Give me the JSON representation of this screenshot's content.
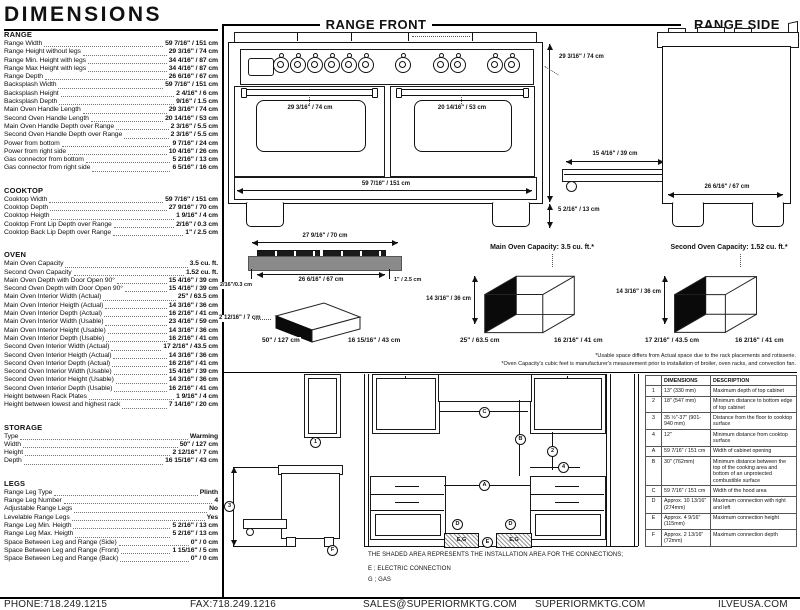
{
  "title": "DIMENSIONS",
  "specs": {
    "range": {
      "heading": "RANGE",
      "rows": [
        {
          "label": "Range Width",
          "value": "59 7/16\" / 151 cm"
        },
        {
          "label": "Range Height without legs",
          "value": "29 3/16\" / 74 cm"
        },
        {
          "label": "Range Min. Height with legs",
          "value": "34 4/16\" / 87 cm"
        },
        {
          "label": "Range Max Height with legs",
          "value": "34 4/16\" / 87 cm"
        },
        {
          "label": "Range Depth",
          "value": "26 6/16\" / 67 cm"
        },
        {
          "label": "Backsplash Width",
          "value": "59 7/16\" / 151 cm"
        },
        {
          "label": "Backsplash Height",
          "value": "2 4/16\" / 6 cm"
        },
        {
          "label": "Backsplash Depth",
          "value": "9/16\" / 1.5 cm"
        },
        {
          "label": "Main Oven Handle Length",
          "value": "29 3/16\" / 74 cm"
        },
        {
          "label": "Second Oven Handle Length",
          "value": "20 14/16\" / 53 cm"
        },
        {
          "label": "Main Oven Handle Depth over Range",
          "value": "2 3/16\" / 5.5 cm"
        },
        {
          "label": "Second Oven Handle Depth over Range",
          "value": "2 3/16\" / 5.5 cm"
        },
        {
          "label": "Power from bottom",
          "value": "9 7/16\" / 24 cm"
        },
        {
          "label": "Power from right side",
          "value": "10 4/16\" / 26 cm"
        },
        {
          "label": "Gas connector from bottom",
          "value": "5 2/16\" / 13 cm"
        },
        {
          "label": "Gas connector from right side",
          "value": "6 5/16\" / 16 cm"
        }
      ]
    },
    "cooktop": {
      "heading": "COOKTOP",
      "rows": [
        {
          "label": "Cooktop Width",
          "value": "59 7/16\" / 151 cm"
        },
        {
          "label": "Cooktop Depth",
          "value": "27 9/16\" / 70 cm"
        },
        {
          "label": "Cooktop Heigth",
          "value": "1 9/16\" / 4 cm"
        },
        {
          "label": "Cooktop Front Lip Depth over Range",
          "value": "2/16\" / 0.3 cm"
        },
        {
          "label": "Cooktop Back Lip Depth over Range",
          "value": "1\" / 2.5 cm"
        }
      ]
    },
    "oven": {
      "heading": "OVEN",
      "rows": [
        {
          "label": "Main Oven Capacity",
          "value": "3.5 cu. ft."
        },
        {
          "label": "Second Oven Capacity",
          "value": "1.52 cu. ft."
        },
        {
          "label": "Main Oven Depth with Door Open 90°",
          "value": "15 4/16\" / 39 cm"
        },
        {
          "label": "Second Oven Depth with Door Open 90°",
          "value": "15 4/16\" / 39 cm"
        },
        {
          "label": "Main Oven Interior Width (Actual)",
          "value": "25\" / 63.5 cm"
        },
        {
          "label": "Main Oven Interior Heigth (Actual)",
          "value": "14 3/16\" / 36 cm"
        },
        {
          "label": "Main Oven Interior Depth (Actual)",
          "value": "16 2/16\" / 41 cm"
        },
        {
          "label": "Main Oven Interior Width (Usable)",
          "value": "23 4/16\" / 59 cm"
        },
        {
          "label": "Main Oven Interior Height (Usable)",
          "value": "14 3/16\" / 36 cm"
        },
        {
          "label": "Main Oven Interior Depth (Usable)",
          "value": "16 2/16\" / 41 cm"
        },
        {
          "label": "Second Oven Interior Width (Actual)",
          "value": "17 2/16\" / 43.5 cm"
        },
        {
          "label": "Second Oven Interior Heigth (Actual)",
          "value": "14 3/16\" / 36 cm"
        },
        {
          "label": "Second Oven Interior Depth (Actual)",
          "value": "16 2/16\" / 41 cm"
        },
        {
          "label": "Second Oven Interior Width (Usable)",
          "value": "15 4/16\" / 39 cm"
        },
        {
          "label": "Second Oven Interior Height (Usable)",
          "value": "14 3/16\" / 36 cm"
        },
        {
          "label": "Second Oven Interior Depth (Usable)",
          "value": "16 2/16\" / 41 cm"
        },
        {
          "label": "Height between Rack Plates",
          "value": "1 9/16\" / 4 cm"
        },
        {
          "label": "Height between lowest and highest rack",
          "value": "7 14/16\" / 20 cm"
        }
      ]
    },
    "storage": {
      "heading": "STORAGE",
      "rows": [
        {
          "label": "Type",
          "value": "Warming"
        },
        {
          "label": "Width",
          "value": "50\" / 127 cm"
        },
        {
          "label": "Height",
          "value": "2 12/16\" / 7 cm"
        },
        {
          "label": "Depth",
          "value": "16 15/16\" / 43 cm"
        }
      ]
    },
    "legs": {
      "heading": "LEGS",
      "rows": [
        {
          "label": "Range Leg Type",
          "value": "Plinth"
        },
        {
          "label": "Range Leg Number",
          "value": "4"
        },
        {
          "label": "Adjustable Range Legs",
          "value": "No"
        },
        {
          "label": "Levelable Range Legs",
          "value": "Yes"
        },
        {
          "label": "Range Leg Min. Heigth",
          "value": "5 2/16\" / 13 cm"
        },
        {
          "label": "Range Leg Max. Heigth",
          "value": "5 2/16\" / 13 cm"
        },
        {
          "label": "Space Between Leg and Range (Side)",
          "value": "0\" / 0 cm"
        },
        {
          "label": "Space Between Leg and Range (Front)",
          "value": "1 15/16\" / 5 cm"
        },
        {
          "label": "Space Between Leg and Range (Back)",
          "value": "0\" / 0 cm"
        }
      ]
    }
  },
  "drawings": {
    "front": {
      "title": "RANGE FRONT",
      "main_handle": "29 3/16\" / 74 cm",
      "second_handle": "20 14/16\" / 53 cm",
      "width": "59 7/16\" / 151 cm",
      "height": "29 3/16\" / 74 cm",
      "leg_height": "5 2/16\" / 13 cm"
    },
    "side": {
      "title": "RANGE SIDE",
      "door_open": "15 4/16\" / 39 cm",
      "depth": "26 6/16\" / 67 cm"
    },
    "cooktop_profile": {
      "width": "27 9/16\" / 70 cm",
      "inner_width": "26 6/16\" / 67 cm",
      "front_lip": "2/16\"/0.3 cm",
      "back_lip": "1\" / 2.5 cm"
    },
    "storage_drawer": {
      "height": "2 12/16\" / 7 cm",
      "width": "50\" / 127 cm",
      "depth": "16 15/16\" / 43 cm"
    },
    "main_capacity": {
      "title": "Main Oven Capacity: 3.5 cu. ft.*",
      "height": "14 3/16\" / 36 cm",
      "width": "25\" / 63.5 cm",
      "depth": "16 2/16\" / 41 cm"
    },
    "second_capacity": {
      "title": "Second Oven Capacity: 1.52 cu. ft.*",
      "height": "14 3/16\" / 36 cm",
      "width": "17 2/16\" / 43.5 cm",
      "depth": "16 2/16\" / 41 cm"
    },
    "footnote1": "*Usable space differs from Actual space due to the rack placements and rotisserie.",
    "footnote2": "*Oven Capacity's cubic feet is manufacturer's measurement prior to installation of broiler, oven racks, and convection fan."
  },
  "installation": {
    "note": "THE SHADED AREA REPRESENTS THE INSTALLATION AREA FOR THE CONNECTIONS;",
    "legend_electric": "E ; ELECTRIC CONNECTION",
    "legend_gas": "G ; GAS",
    "eg_label": "E,G",
    "callouts": {
      "c1": "1",
      "c2": "2",
      "c3": "3",
      "c4": "4",
      "a": "A",
      "b": "B",
      "c": "C",
      "d": "D",
      "e": "E",
      "f": "F"
    }
  },
  "table": {
    "headers": {
      "dimensions": "DIMENSIONS",
      "description": "DESCRIPTION"
    },
    "rows": [
      {
        "ref": "1",
        "dim": "13\" (330 mm)",
        "desc": "Maximum depth of top cabinet"
      },
      {
        "ref": "2",
        "dim": "18\" (547 mm)",
        "desc": "Minimum distance to bottom edge of top cabinet"
      },
      {
        "ref": "3",
        "dim": "35 ½\"-37\" (901-940 mm)",
        "desc": "Distance from the floor to cooktop surface"
      },
      {
        "ref": "4",
        "dim": "12\"",
        "desc": "Minimum distance from cooktop surface"
      },
      {
        "ref": "A",
        "dim": "59 7/16\" / 151 cm",
        "desc": "Width of cabinet opening"
      },
      {
        "ref": "B",
        "dim": "30\" (762mm)",
        "desc": "Minimum distance between the top of the cooking area and bottom of an unprotected combustible surface"
      },
      {
        "ref": "C",
        "dim": "59 7/16\" / 151 cm",
        "desc": "Width of the hood area"
      },
      {
        "ref": "D",
        "dim": "Approx. 10 13/16\" (274mm)",
        "desc": "Maximum connection with right and left"
      },
      {
        "ref": "E",
        "dim": "Approx. 4 9/16\" (115mm)",
        "desc": "Maximum connection height"
      },
      {
        "ref": "F",
        "dim": "Approx. 2 13/16\" (72mm)",
        "desc": "Maximum connection depth"
      }
    ]
  },
  "footer": {
    "phone": "PHONE:718.249.1215",
    "fax": "FAX:718.249.1216",
    "email": "SALES@SUPERIORMKTG.COM",
    "site": "SUPERIORMKTG.COM",
    "site2": "ILVEUSA.COM"
  }
}
